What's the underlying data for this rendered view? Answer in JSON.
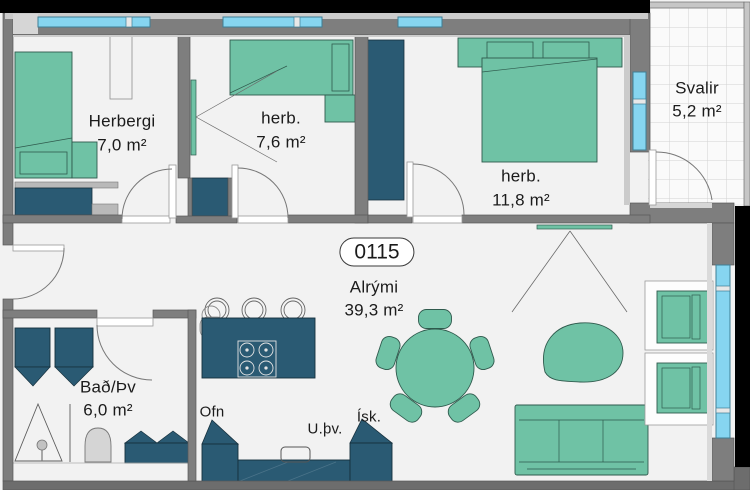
{
  "palette": {
    "floor": "#f2f2f2",
    "wall": "#7e7e7e",
    "wall_dark": "#6d6d6d",
    "wall_light": "#cbcbcb",
    "outline": "#585858",
    "green": "#6fc2a5",
    "green_dark": "#2f5a4d",
    "teal": "#2a5a73",
    "teal_dark": "#16303d",
    "window": "#86d5f0",
    "window_frame": "#3f7e95",
    "grid": "#d2d2d2",
    "black": "#000000",
    "text": "#1b1b1b"
  },
  "unit": {
    "number": "0115"
  },
  "rooms": [
    {
      "id": "herbergi",
      "name": "Herbergi",
      "area": "7,0 m²"
    },
    {
      "id": "herb2",
      "name": "herb.",
      "area": "7,6 m²"
    },
    {
      "id": "herb3",
      "name": "herb.",
      "area": "11,8 m²"
    },
    {
      "id": "svalir",
      "name": "Svalir",
      "area": "5,2 m²"
    },
    {
      "id": "alrymi",
      "name": "Alrými",
      "area": "39,3 m²"
    },
    {
      "id": "bad",
      "name": "Bað/Þv",
      "area": "6,0 m²"
    }
  ],
  "appliances": {
    "oven": "Ofn",
    "dishwasher": "U.þv.",
    "fridge": "Ísk."
  }
}
